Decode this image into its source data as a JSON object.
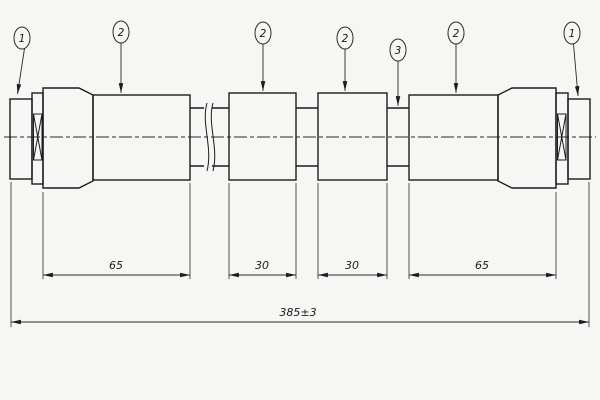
{
  "drawing": {
    "type": "hose-assembly-technical-drawing",
    "background_color": "#f6f6f4",
    "line_color": "#1c1c1c",
    "balloons": [
      {
        "label": "1"
      },
      {
        "label": "2"
      },
      {
        "label": "2"
      },
      {
        "label": "2"
      },
      {
        "label": "3"
      },
      {
        "label": "2"
      },
      {
        "label": "1"
      }
    ],
    "dimensions": {
      "left_sleeve": "65",
      "mid_left": "30",
      "mid_right": "30",
      "right_sleeve": "65",
      "overall": "385±3"
    }
  }
}
